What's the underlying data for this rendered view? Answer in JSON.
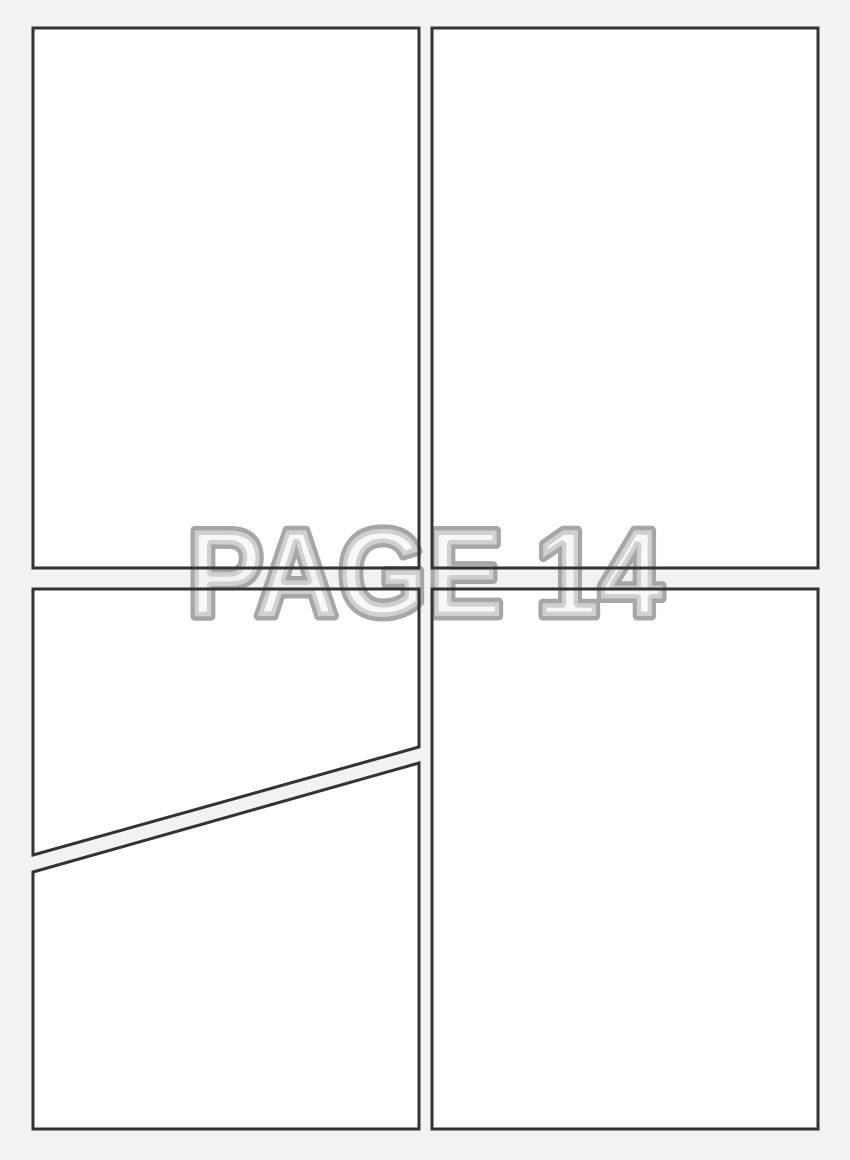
{
  "page": {
    "label": "Blank comic page panel template",
    "watermark": {
      "text": "PAGE 14"
    },
    "colors": {
      "background": "#f2f2f2",
      "panel_fill": "#ffffff",
      "panel_border": "#333333",
      "watermark_fill": "#f3f3f3",
      "watermark_stroke": "#a6a6a6"
    },
    "panels": [
      {
        "name": "top-left"
      },
      {
        "name": "top-right"
      },
      {
        "name": "bottom-left-upper"
      },
      {
        "name": "bottom-left-lower"
      },
      {
        "name": "bottom-right"
      }
    ]
  }
}
